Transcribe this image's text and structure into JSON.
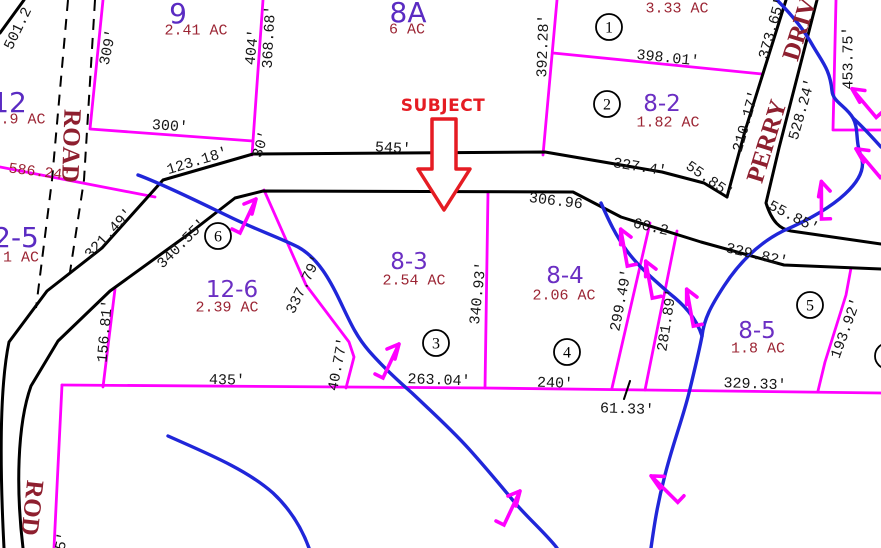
{
  "map": {
    "subject_label": "SUBJECT",
    "road_names": [
      "ROAD",
      "PERRY DRIVE",
      "ROD"
    ],
    "parcels": [
      {
        "id": "9",
        "acreage": "2.41 AC"
      },
      {
        "id": "8A",
        "acreage": "6 AC"
      },
      {
        "id": "12",
        "acreage": ".9 AC"
      },
      {
        "id": "2-5",
        "acreage": "1 AC"
      },
      {
        "id": "12-6",
        "acreage": "2.39 AC"
      },
      {
        "id": "8-2",
        "acreage": "1.82 AC"
      },
      {
        "id": "8-3",
        "acreage": "2.54 AC"
      },
      {
        "id": "8-4",
        "acreage": "2.06 AC"
      },
      {
        "id": "8-5",
        "acreage": "1.8 AC"
      },
      {
        "id": "",
        "acreage": "3.33 AC"
      }
    ],
    "colors": {
      "parcel_line": "#FF00FF",
      "road_line": "#000000",
      "stream": "#2026D9",
      "parcel_number": "#6B2FC3",
      "dimension_text": "#161616",
      "acreage_text": "#9B2433",
      "road_name_text": "#8E1F2F",
      "subject_red": "#E51C23"
    },
    "labels": [
      {
        "t": "501.2",
        "x": 17,
        "y": 28,
        "r": -64,
        "c": "dim"
      },
      {
        "t": "309'",
        "x": 107,
        "y": 47,
        "r": -78,
        "c": "dim"
      },
      {
        "t": "404'",
        "x": 251,
        "y": 47,
        "r": -84,
        "c": "dim"
      },
      {
        "t": "368.68'",
        "x": 268,
        "y": 37,
        "r": -87,
        "c": "dim"
      },
      {
        "t": "300'",
        "x": 170,
        "y": 125,
        "r": 4,
        "c": "dim"
      },
      {
        "t": "123.18'",
        "x": 197,
        "y": 160,
        "r": -17,
        "c": "dim"
      },
      {
        "t": "30'",
        "x": 260,
        "y": 144,
        "r": -72,
        "c": "dim"
      },
      {
        "t": "545'",
        "x": 393,
        "y": 147,
        "r": 3,
        "c": "dim"
      },
      {
        "t": "392.28'",
        "x": 542,
        "y": 46,
        "r": -88,
        "c": "dim"
      },
      {
        "t": "398.01'",
        "x": 668,
        "y": 57,
        "r": 6,
        "c": "dim"
      },
      {
        "t": "327.4'",
        "x": 640,
        "y": 166,
        "r": 9,
        "c": "dim"
      },
      {
        "t": "55.85'",
        "x": 710,
        "y": 179,
        "r": 35,
        "c": "dim"
      },
      {
        "t": "55.85'",
        "x": 794,
        "y": 216,
        "r": 27,
        "c": "dim"
      },
      {
        "t": "373.65'",
        "x": 771,
        "y": 28,
        "r": -74,
        "c": "dim"
      },
      {
        "t": "210.17'",
        "x": 745,
        "y": 121,
        "r": -74,
        "c": "dim"
      },
      {
        "t": "528.24'",
        "x": 801,
        "y": 109,
        "r": -74,
        "c": "dim"
      },
      {
        "t": "453.75'",
        "x": 847,
        "y": 58,
        "r": -90,
        "c": "dim"
      },
      {
        "t": "306.96",
        "x": 556,
        "y": 200,
        "r": 7,
        "c": "dim"
      },
      {
        "t": "60.2",
        "x": 651,
        "y": 226,
        "r": 13,
        "c": "dim"
      },
      {
        "t": "329.82'",
        "x": 757,
        "y": 254,
        "r": 13,
        "c": "dim"
      },
      {
        "t": "321.49'",
        "x": 108,
        "y": 233,
        "r": -47,
        "c": "dim"
      },
      {
        "t": "340.55'",
        "x": 181,
        "y": 243,
        "r": -45,
        "c": "dim"
      },
      {
        "t": "337.79'",
        "x": 303,
        "y": 284,
        "r": -64,
        "c": "dim"
      },
      {
        "t": "340.93'",
        "x": 477,
        "y": 293,
        "r": -84,
        "c": "dim"
      },
      {
        "t": "299.49'",
        "x": 620,
        "y": 300,
        "r": -79,
        "c": "dim"
      },
      {
        "t": "281.89'",
        "x": 666,
        "y": 320,
        "r": -81,
        "c": "dim"
      },
      {
        "t": "156.81'",
        "x": 104,
        "y": 331,
        "r": -85,
        "c": "dim"
      },
      {
        "t": "40.77'",
        "x": 337,
        "y": 364,
        "r": -79,
        "c": "dim"
      },
      {
        "t": "435'",
        "x": 227,
        "y": 379,
        "r": 1,
        "c": "dim"
      },
      {
        "t": "263.04'",
        "x": 439,
        "y": 379,
        "r": 2,
        "c": "dim"
      },
      {
        "t": "240'",
        "x": 555,
        "y": 382,
        "r": 2,
        "c": "dim"
      },
      {
        "t": "61.33'",
        "x": 627,
        "y": 408,
        "r": 2,
        "c": "dim"
      },
      {
        "t": "329.33'",
        "x": 755,
        "y": 383,
        "r": 2,
        "c": "dim"
      },
      {
        "t": "193.92'",
        "x": 845,
        "y": 328,
        "r": -70,
        "c": "dim"
      },
      {
        "t": "5'",
        "x": 61,
        "y": 541,
        "r": -78,
        "c": "dim"
      },
      {
        "t": "2.41 AC",
        "x": 196,
        "y": 29,
        "r": 0,
        "c": "ac"
      },
      {
        "t": "6 AC",
        "x": 407,
        "y": 28,
        "r": 0,
        "c": "ac"
      },
      {
        "t": "3.33 AC",
        "x": 677,
        "y": 7,
        "r": 0,
        "c": "ac"
      },
      {
        "t": "1.82 AC",
        "x": 668,
        "y": 121,
        "r": 0,
        "c": "ac"
      },
      {
        "t": ".9 AC",
        "x": 23,
        "y": 118,
        "r": 0,
        "c": "ac"
      },
      {
        "t": "1 AC",
        "x": 21,
        "y": 256,
        "r": 0,
        "c": "ac"
      },
      {
        "t": "2.39 AC",
        "x": 227,
        "y": 306,
        "r": 0,
        "c": "ac"
      },
      {
        "t": "2.54 AC",
        "x": 414,
        "y": 279,
        "r": 0,
        "c": "ac"
      },
      {
        "t": "2.06 AC",
        "x": 564,
        "y": 294,
        "r": 0,
        "c": "ac"
      },
      {
        "t": "1.8 AC",
        "x": 758,
        "y": 347,
        "r": 0,
        "c": "ac"
      },
      {
        "t": "586.24'",
        "x": 40,
        "y": 171,
        "r": 7,
        "c": "ac"
      },
      {
        "t": "9",
        "x": 178,
        "y": 13,
        "r": 0,
        "c": "parcel-big"
      },
      {
        "t": "8A",
        "x": 408,
        "y": 12,
        "r": 0,
        "c": "parcel-big"
      },
      {
        "t": "12",
        "x": 9,
        "y": 102,
        "r": 0,
        "c": "parcel-big"
      },
      {
        "t": "2-5",
        "x": 16,
        "y": 237,
        "r": 0,
        "c": "parcel-big"
      },
      {
        "t": "12-6",
        "x": 232,
        "y": 289,
        "r": 0,
        "c": "parcel"
      },
      {
        "t": "8-2",
        "x": 662,
        "y": 103,
        "r": 0,
        "c": "parcel"
      },
      {
        "t": "8-3",
        "x": 409,
        "y": 261,
        "r": 0,
        "c": "parcel"
      },
      {
        "t": "8-4",
        "x": 565,
        "y": 275,
        "r": 0,
        "c": "parcel"
      },
      {
        "t": "8-5",
        "x": 757,
        "y": 330,
        "r": 0,
        "c": "parcel"
      },
      {
        "t": "ROAD",
        "x": 72,
        "y": 146,
        "r": 92,
        "c": "road"
      },
      {
        "t": "PERRY",
        "x": 766,
        "y": 141,
        "r": -73,
        "c": "road"
      },
      {
        "t": "DRIVE",
        "x": 801,
        "y": 21,
        "r": -73,
        "c": "road"
      },
      {
        "t": "ROD",
        "x": 33,
        "y": 508,
        "r": 96,
        "c": "road"
      },
      {
        "t": "SUBJECT",
        "x": 443,
        "y": 105,
        "r": 0,
        "c": "subject"
      }
    ],
    "circled_numbers": [
      {
        "n": "1",
        "x": 609,
        "y": 27
      },
      {
        "n": "2",
        "x": 607,
        "y": 104
      },
      {
        "n": "3",
        "x": 436,
        "y": 343
      },
      {
        "n": "4",
        "x": 567,
        "y": 352
      },
      {
        "n": "5",
        "x": 810,
        "y": 305
      },
      {
        "n": "6",
        "x": 218,
        "y": 236
      },
      {
        "n": "",
        "x": 888,
        "y": 356
      }
    ],
    "flow_arrows": [
      {
        "x": 247,
        "y": 212,
        "r": 0,
        "flip": false
      },
      {
        "x": 390,
        "y": 357,
        "r": 0,
        "flip": false
      },
      {
        "x": 511,
        "y": 504,
        "r": 0,
        "flip": false
      },
      {
        "x": 664,
        "y": 485,
        "r": -20,
        "flip": true
      },
      {
        "x": 626,
        "y": 244,
        "r": 15,
        "flip": true
      },
      {
        "x": 651,
        "y": 276,
        "r": 15,
        "flip": true
      },
      {
        "x": 692,
        "y": 304,
        "r": 15,
        "flip": true
      },
      {
        "x": 864,
        "y": 99,
        "r": -15,
        "flip": true
      },
      {
        "x": 868,
        "y": 159,
        "r": -15,
        "flip": true
      },
      {
        "x": 824,
        "y": 197,
        "r": 25,
        "flip": true
      }
    ]
  }
}
